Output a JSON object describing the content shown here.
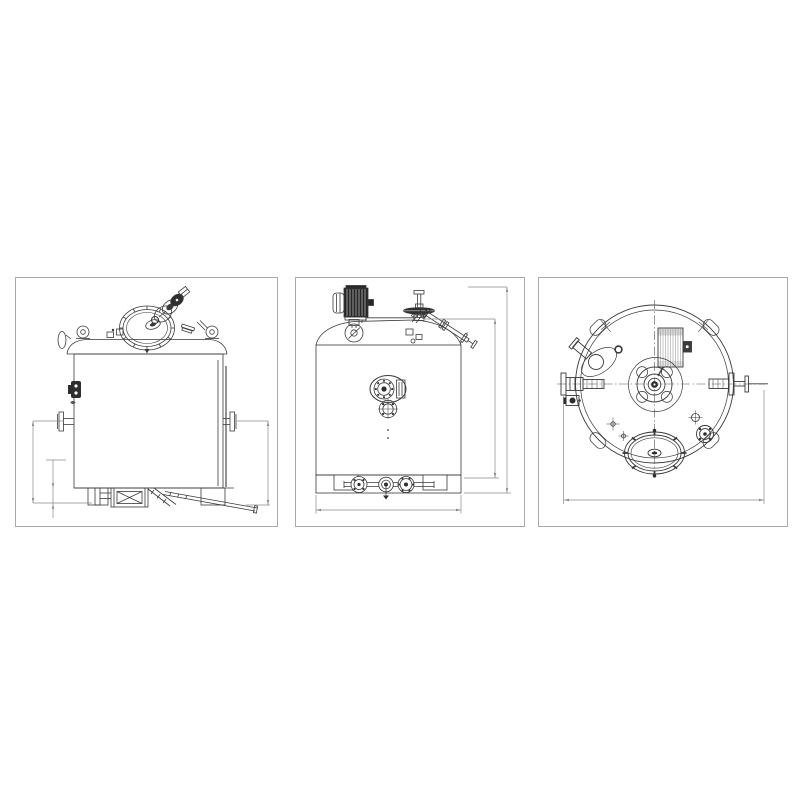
{
  "page": {
    "background_color": "#ffffff"
  },
  "figure": {
    "type": "technical-drawing",
    "description": "Three-view engineering drawing of a vertical agitated mixing tank",
    "colors": {
      "line": "#3a3a3a",
      "dimension_line": "#8a8a8a",
      "panel_border": "#a9a9a9",
      "dark_fill": "#2e2e2e",
      "background": "#ffffff"
    },
    "panels": [
      {
        "name": "side-elevation-view",
        "features": [
          "manway-lid-with-clamps",
          "vent-valve-cluster",
          "lifting-lugs",
          "side-nozzles-with-flanges",
          "side-clamp-port",
          "support-legs",
          "drain-valve-box",
          "discharge-pipes",
          "vertical-dimension-lines"
        ]
      },
      {
        "name": "front-elevation-view",
        "features": [
          "agitator-motor",
          "agitator-shaft-with-impeller",
          "angled-inlet-pipe",
          "dome-head",
          "sight-glass-assembly",
          "sample-flange",
          "skirt-with-cutouts",
          "bottom-pipework-with-flanges",
          "height-dimension-lines",
          "width-dimension-line"
        ]
      },
      {
        "name": "top-plan-view",
        "features": [
          "shell-outline-circles",
          "corner-lugs",
          "center-hub-flange",
          "agitator-motor",
          "manway-cover",
          "left-nozzle",
          "right-nozzle",
          "angled-nozzle",
          "small-ports",
          "center-lines",
          "diameter-dimension-line"
        ]
      }
    ]
  }
}
